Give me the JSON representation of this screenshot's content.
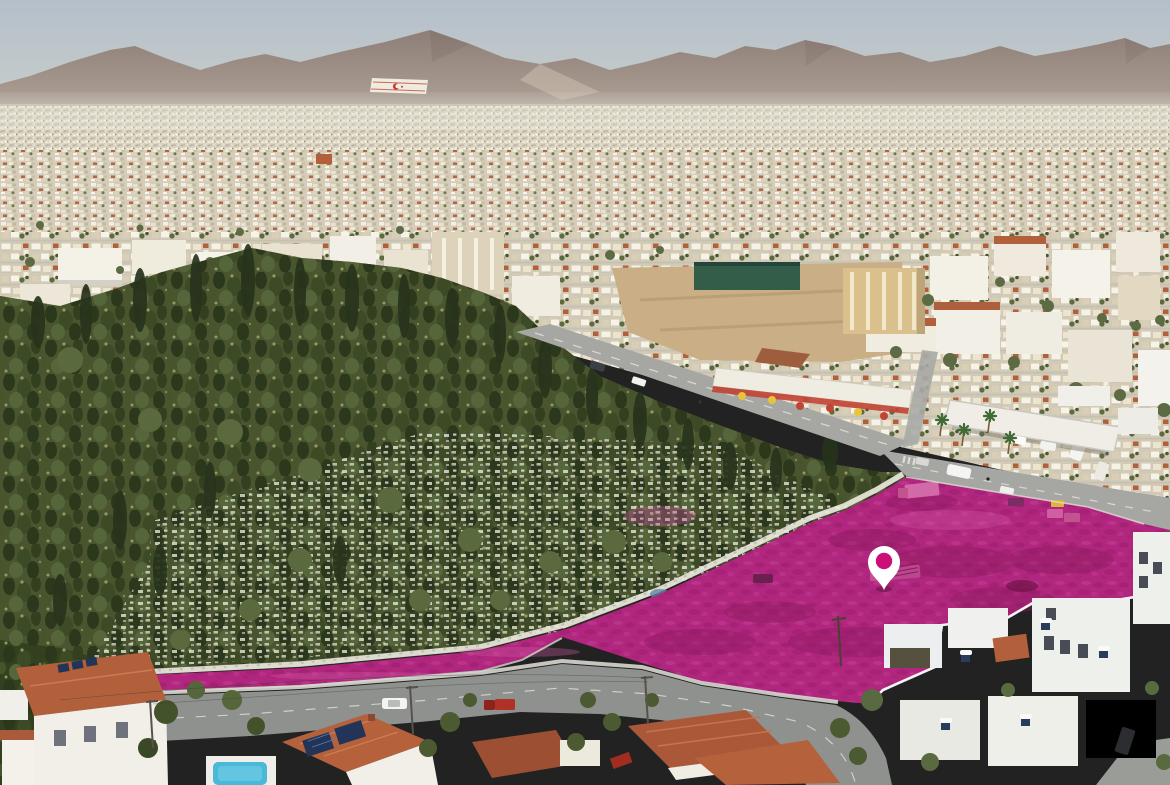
{
  "scene": {
    "type": "aerial-drone-photo",
    "subject": "city aerial view with highlighted land plot for sale and location pin",
    "landmarks": {
      "mountain_range": "mountain ridge on horizon with flag painted on slope",
      "cemetery": "dense cypress-tree cemetery left of plot",
      "plot": "magenta overlay marking vacant land parcel",
      "pin": "white map pin with magenta dot centered on plot"
    }
  },
  "colors": {
    "sky_top": "#b4bfc9",
    "sky_bottom": "#ccd0cc",
    "mountain_top": "#8d7e77",
    "mountain_bottom": "#b8ab9e",
    "flag_white": "#f2efe4",
    "flag_red": "#c23a2e",
    "city_base": "#d8d1bf",
    "dirt_field": "#c9ae86",
    "green_fence": "#335c49",
    "restaurant_canopy": "#efece2",
    "awning_red": "#c14434",
    "road": "#a6a7a3",
    "road_dark": "#8e918e",
    "curb": "#e0dfd8",
    "forest_base": "#4a5530",
    "forest_dark": "#2c381c",
    "grave_white": "#ecede3",
    "wall_white": "#e9e6dc",
    "plot_overlay": "#b1267e",
    "plot_dark": "#8a1a5f",
    "plot_light": "#cf58a2",
    "pin_white": "#ffffff",
    "pin_dot": "#cc0e78",
    "roof_terracotta": "#b2603c",
    "roof_dark_red": "#9c4f33",
    "house_white": "#f1efe8",
    "pool_blue": "#4ab8d8",
    "solar_panel": "#223457",
    "car_red": "#b03226",
    "truck_pink": "#d269a8",
    "dumpster_yellow": "#ddb43c"
  }
}
